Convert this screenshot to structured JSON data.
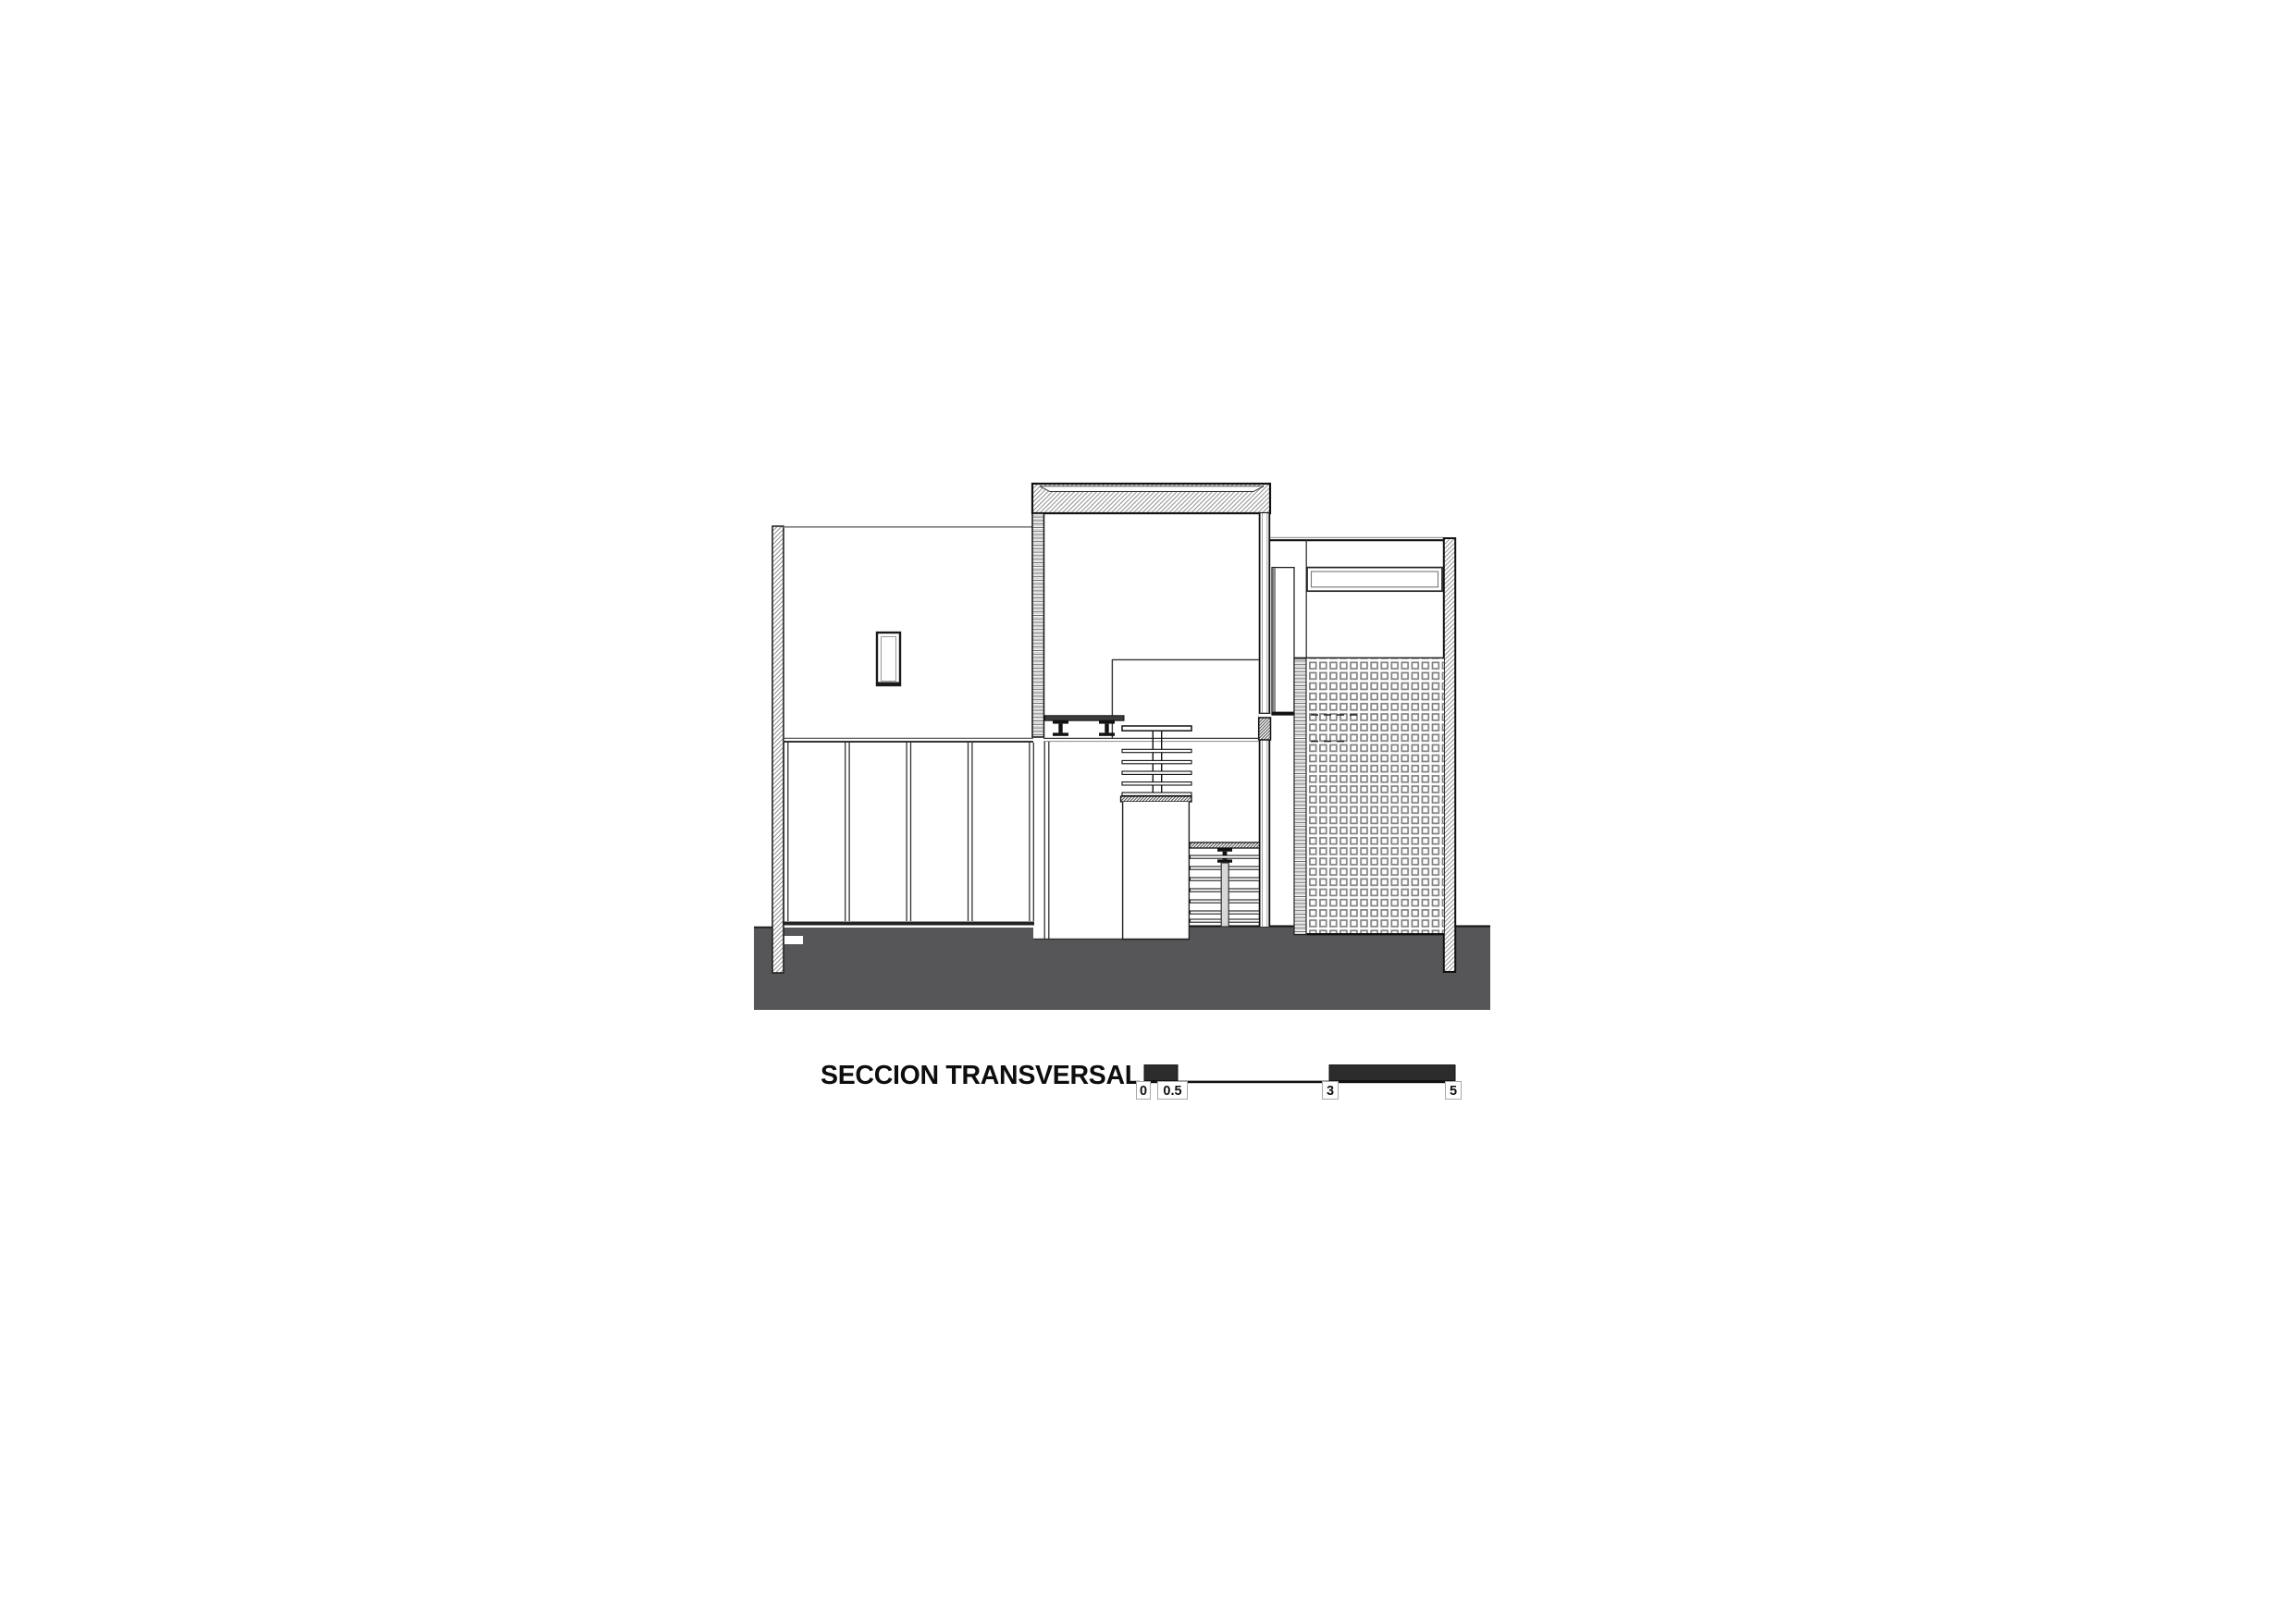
{
  "drawing": {
    "title": "SECCION TRANSVERSAL",
    "kind": "architectural cross-section drawing",
    "ground_color": "#565658",
    "line_color": "#111111",
    "hatch_color": "#8f8f8f",
    "dark_fill_color": "#2c2c2c"
  },
  "scale_bar": {
    "labels": [
      "0",
      "0.5",
      "3",
      "5"
    ]
  }
}
